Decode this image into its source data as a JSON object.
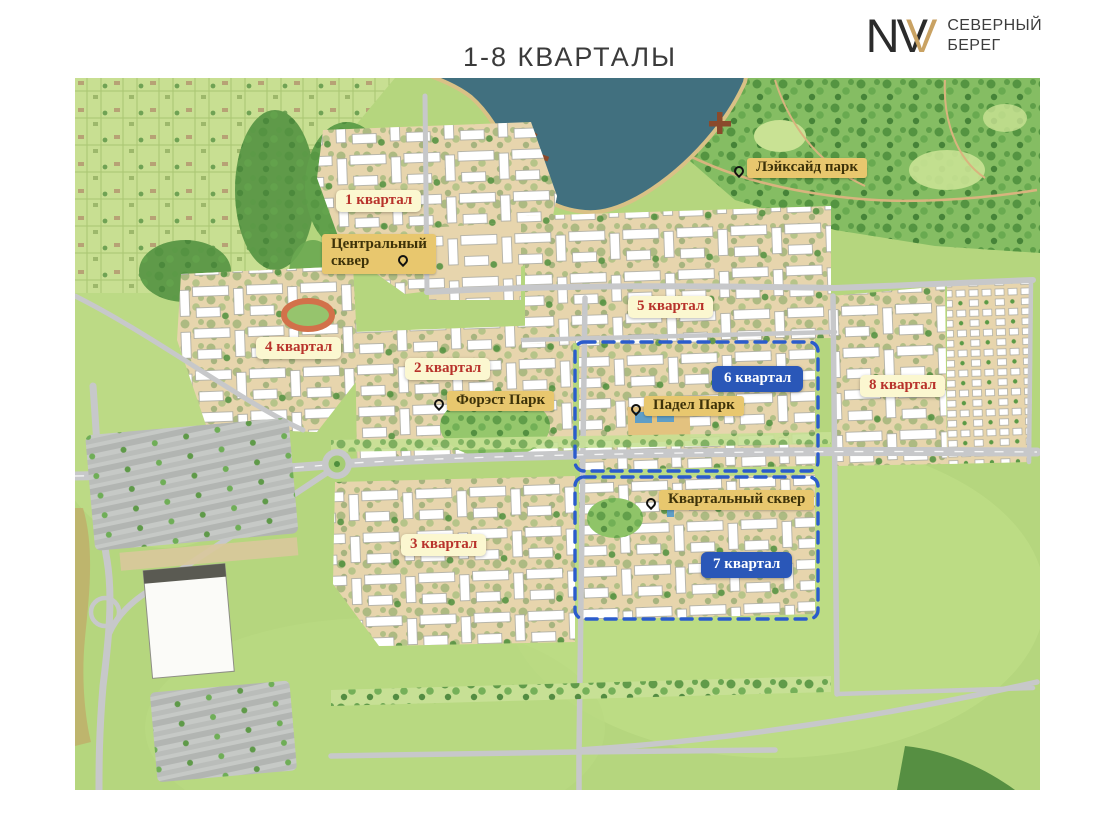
{
  "page": {
    "title": "1-8 КВАРТАЛЫ"
  },
  "logo": {
    "monogram": "NV",
    "monogram_accent": "V",
    "name_line1": "СЕВЕРНЫЙ",
    "name_line2": "БЕРЕГ"
  },
  "map": {
    "quarter_labels": [
      {
        "id": 1,
        "text": "1 квартал",
        "style": "red"
      },
      {
        "id": 2,
        "text": "2 квартал",
        "style": "red"
      },
      {
        "id": 3,
        "text": "3 квартал",
        "style": "red"
      },
      {
        "id": 4,
        "text": "4 квартал",
        "style": "red"
      },
      {
        "id": 5,
        "text": "5 квартал",
        "style": "red"
      },
      {
        "id": 6,
        "text": "6 квартал",
        "style": "blue"
      },
      {
        "id": 7,
        "text": "7 квартал",
        "style": "blue"
      },
      {
        "id": 8,
        "text": "8 квартал",
        "style": "red"
      }
    ],
    "place_labels": [
      {
        "id": "central-square",
        "text": "Центральный сквер"
      },
      {
        "id": "lakeside-park",
        "text": "Лэйксайд парк"
      },
      {
        "id": "forest-park",
        "text": "Форэст Парк"
      },
      {
        "id": "padel-park",
        "text": "Падел Парк"
      },
      {
        "id": "block-square",
        "text": "Квартальный сквер"
      }
    ],
    "highlighted_quarters": [
      6,
      7
    ]
  },
  "colors": {
    "title_text": "#3b3b3b",
    "logo_black": "#2b2b2b",
    "logo_gold": "#c9a263",
    "label_red_text": "#b8322b",
    "label_cream_bg": "#fbf7d0",
    "label_blue_bg": "#2a57b8",
    "place_label_bg": "#e8c76e",
    "place_label_text": "#3d3209",
    "boundary_blue": "#2b5ccc",
    "lake": "#41707f",
    "field": "#b5d67e",
    "road": "#c7c8ca",
    "forest": "#5f9a49"
  }
}
